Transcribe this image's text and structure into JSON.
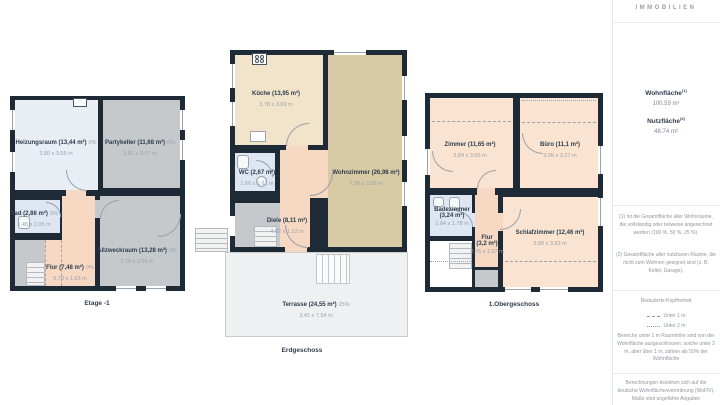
{
  "brand": {
    "logo_text": "IMMOBILIEN"
  },
  "summary": {
    "wohnflaeche_label": "Wohnfläche",
    "wohnflaeche_sup": "(1)",
    "wohnflaeche_value": "100.59 m²",
    "nutzflaeche_label": "Nutzfläche",
    "nutzflaeche_sup": "(2)",
    "nutzflaeche_value": "48.74 m²"
  },
  "footnotes": {
    "note1": "(1) Ist die Gesamtfläche aller Wohnräume, die vollständig oder teilweise angerechnet werden (100 %, 50 %, 25 %).",
    "note2": "(2) Gesamtfläche aller nutzbaren Räume, die nicht zum Wohnen geeignet sind (z. B. Keller, Garage)."
  },
  "headroom_legend": {
    "title": "Reduzierte Kopffreiheit",
    "items": [
      {
        "style": "dashed",
        "label": "Unter 1 m"
      },
      {
        "style": "dotted",
        "label": "Unter 2 m"
      }
    ],
    "description": "Bereiche unter 1 m Raumhöhe sind von der Wohnfläche ausgeschlossen; solche unter 2 m, aber über 1 m, zählen als 50% der Wohnfläche"
  },
  "disclaimer": "Berechnungen beziehen sich auf die deutsche Wohnflächenverordnung (WoFlV). Maße sind ungefähre Angaben",
  "floors": [
    {
      "title": "Etage -1",
      "rooms": [
        {
          "name": "Heizungsraum (13,44 m²)",
          "pct": "0%",
          "dims": "3.80 x 3.55 m"
        },
        {
          "name": "Partykeller (11,68 m²)",
          "pct": "0%",
          "dims": "3.81 x 3.07 m"
        },
        {
          "name": "Bad (2,86 m²)",
          "pct": "0%",
          "dims": "1.45 x 2.05 m"
        },
        {
          "name": "Allzweckraum (13,28 m²)",
          "pct": "0%",
          "dims": "3.78 x 3.56 m"
        },
        {
          "name": "Flur (7,48 m²)",
          "pct": "0%",
          "dims": "5.73 x 1.63 m"
        }
      ]
    },
    {
      "title": "Erdgeschoss",
      "rooms": [
        {
          "name": "Küche (13,95 m²)",
          "pct": "",
          "dims": "3.78 x 3.69 m"
        },
        {
          "name": "Wohnzimmer (26,98 m²)",
          "pct": "",
          "dims": "7.99 x 3.09 m"
        },
        {
          "name": "WC (2,67 m²)",
          "pct": "",
          "dims": "1.66 x 1.61 m"
        },
        {
          "name": "Diele (8,11 m²)",
          "pct": "",
          "dims": "4.02 x 1.13 m"
        },
        {
          "name": "Terrasse (24,55 m²)",
          "pct": "25%",
          "dims": "3.41 x 7.54 m"
        }
      ]
    },
    {
      "title": "1.Obergeschoss",
      "rooms": [
        {
          "name": "Zimmer (11,65 m²)",
          "pct": "",
          "dims": "3.84 x 3.55 m"
        },
        {
          "name": "Büro (11,1 m²)",
          "pct": "",
          "dims": "3.95 x 3.27 m"
        },
        {
          "name": "Badezimmer",
          "name2": "(3,24 m²)",
          "pct": "",
          "dims": "1.84 x 1.78 m"
        },
        {
          "name": "Flur",
          "name2": "(3,2 m²)",
          "pct": "",
          "dims": "2.76 x 1.07 m"
        },
        {
          "name": "Schlafzimmer (12,46 m²)",
          "pct": "",
          "dims": "3.88 x 3.83 m"
        }
      ]
    }
  ],
  "icons": [
    "stove-icon",
    "sink-icon",
    "toilet-icon",
    "stairs-icon",
    "window-marker",
    "door-arc",
    "chimney-icon"
  ],
  "colors": {
    "wall": "#1f2a37",
    "room_gray": "#c6c9cb",
    "room_lightblue": "#dee6f2",
    "room_heizung": "#e9eef4",
    "room_peach": "#f6d8c3",
    "room_cream": "#f2e4ca",
    "room_tan": "#d7caa4",
    "room_peach_light": "#fae4d1",
    "terrace": "#eff0f1",
    "label_dark": "#2e3d4d",
    "label_gray": "#9aa2ad"
  }
}
